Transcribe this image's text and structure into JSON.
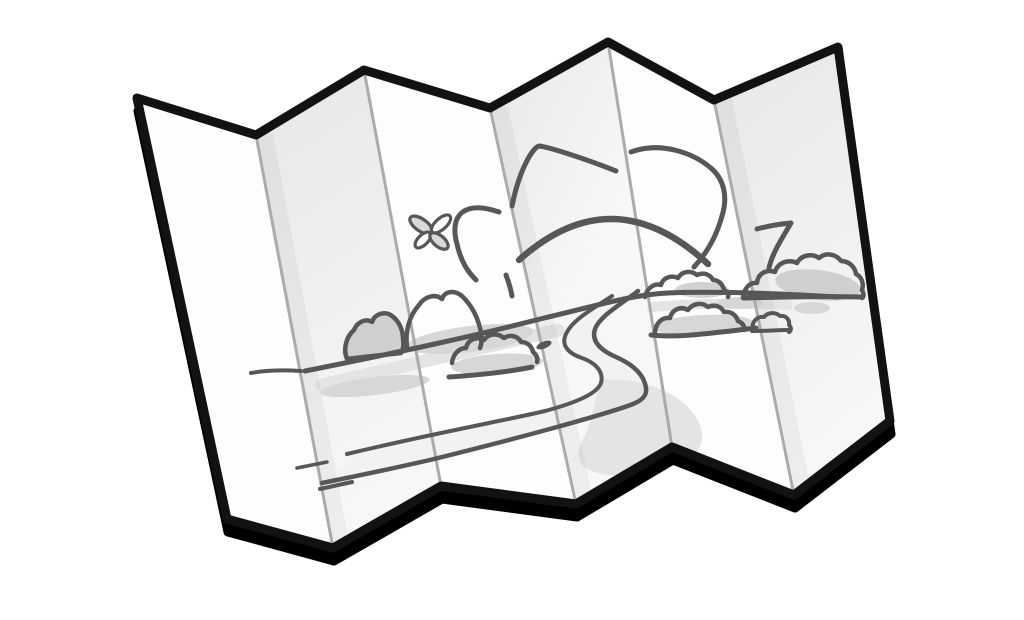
{
  "illustration": {
    "subject": "folded-paper-map",
    "panel_count": 6,
    "crease_count": 5,
    "scene_elements": [
      "sunburst-rays",
      "rising-sun",
      "butterfly",
      "horizon-line",
      "bush-clusters",
      "winding-road",
      "foreground-road-edges"
    ]
  },
  "colors": {
    "background": "#ffffff",
    "paper": "#fdfdfd",
    "panelShadeDark": "#e7e7e7",
    "panelShadeLight": "#f7f7f7",
    "outline": "#121212",
    "shadow": "#000000",
    "crease": "#ababab",
    "creaseBand": "rgba(0,0,0,0.038)",
    "ink": "#57575a",
    "bushFill": "#cfcfcf",
    "underlay": "#d7d7d7",
    "patch": "#d2d2d2",
    "softBand": "#e4e4e4",
    "roadFill": "#f2f2f2",
    "roadBlob": "#e4e4e4",
    "wingFill": "#d9d9d9",
    "wingAlt": "#ffffff"
  }
}
